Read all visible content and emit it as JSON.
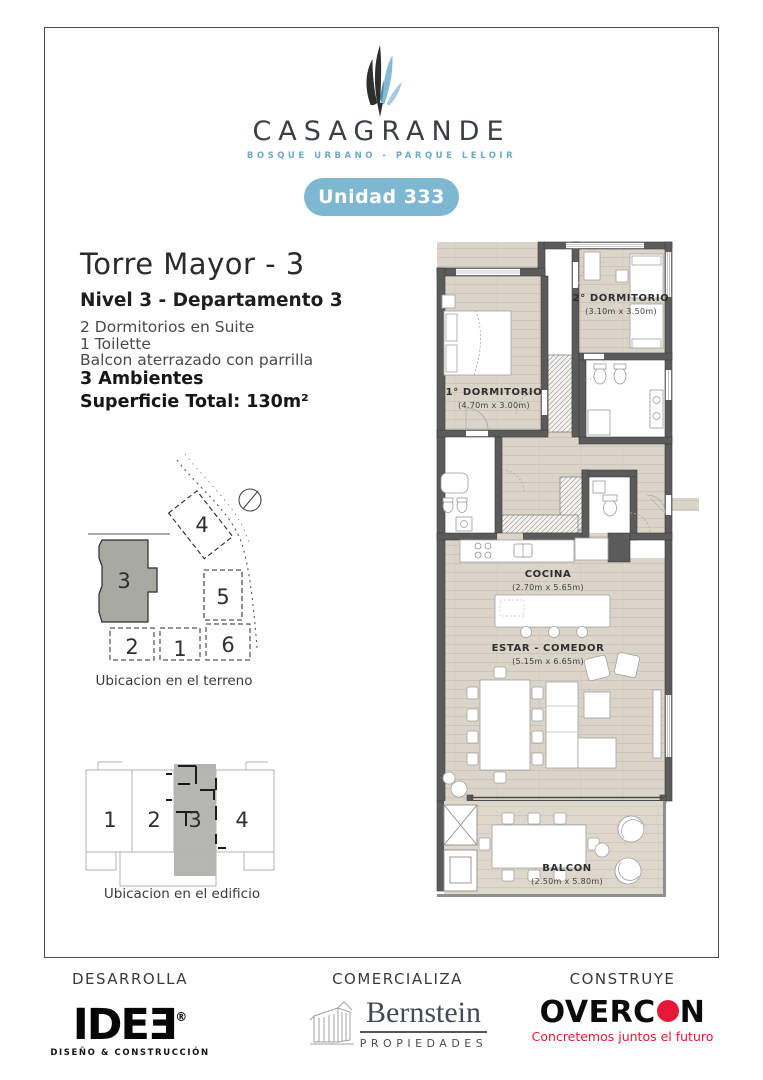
{
  "brand": {
    "name": "CASAGRANDE",
    "tagline": "BOSQUE URBANO - PARQUE LELOIR",
    "unit_badge": "Unidad 333"
  },
  "listing": {
    "title": "Torre Mayor - 3",
    "subtitle": "Nivel 3 - Departamento 3",
    "features": [
      "2 Dormitorios en Suite",
      "1 Toilette",
      "Balcon aterrazado con parrilla"
    ],
    "ambientes": "3 Ambientes",
    "superficie": "Superficie Total: 130m²"
  },
  "floorplan": {
    "rooms": [
      {
        "name": "2° DORMITORIO",
        "dims": "(3.10m x 3.50m)"
      },
      {
        "name": "1° DORMITORIO",
        "dims": "(4.70m x 3.00m)"
      },
      {
        "name": "COCINA",
        "dims": "(2.70m x 5.65m)"
      },
      {
        "name": "ESTAR - COMEDOR",
        "dims": "(5.15m x 6.65m)"
      },
      {
        "name": "BALCON",
        "dims": "(2.50m x 5.80m)"
      }
    ]
  },
  "site": {
    "caption": "Ubicacion en el terreno",
    "buildings": [
      "3",
      "4",
      "5",
      "2",
      "1",
      "6"
    ]
  },
  "building": {
    "caption": "Ubicacion en el edificio",
    "units": [
      "1",
      "2",
      "3",
      "4"
    ]
  },
  "footer": {
    "roles": [
      "DESARROLLA",
      "COMERCIALIZA",
      "CONSTRUYE"
    ],
    "idee": {
      "name": "IDEƎ",
      "reg": "®",
      "tagline": "DISEÑO & CONSTRUCCIÓN"
    },
    "bernstein": {
      "name": "Bernstein",
      "tagline": "PROPIEDADES"
    },
    "overcon": {
      "left": "OVERC",
      "right": "N",
      "tagline": "Concretemos juntos el futuro"
    }
  },
  "colors": {
    "accent_blue": "#7db7d2",
    "tagline_blue": "#6ea9c7",
    "leaf_blue": "#85b9d4",
    "logo_dark": "#2e2e2e",
    "wall_gray": "#5b5b5b",
    "floor_beige": "#dbd4c8",
    "highlight_gray": "#b5b6b1",
    "overcon_red": "#e41937"
  }
}
